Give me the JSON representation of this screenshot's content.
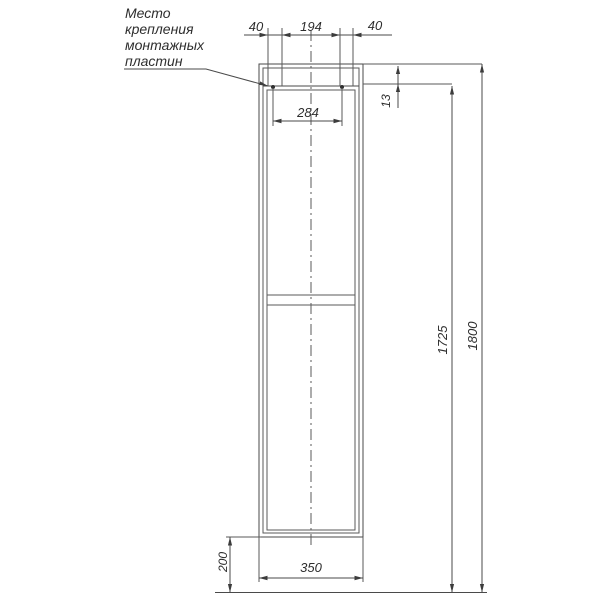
{
  "note": {
    "lines": [
      "Место",
      "крепления",
      "монтажных",
      "пластин"
    ]
  },
  "dims": {
    "plate_left_offset": "40",
    "plate_spacing": "194",
    "plate_right_offset": "40",
    "plate_span": "284",
    "plate_top_offset": "13",
    "mount_height": "1725",
    "total_height": "1800",
    "width": "350",
    "bottom_clearance": "200"
  },
  "colors": {
    "line": "#4a4a4a",
    "text": "#2e2e2e",
    "background": "#ffffff"
  }
}
